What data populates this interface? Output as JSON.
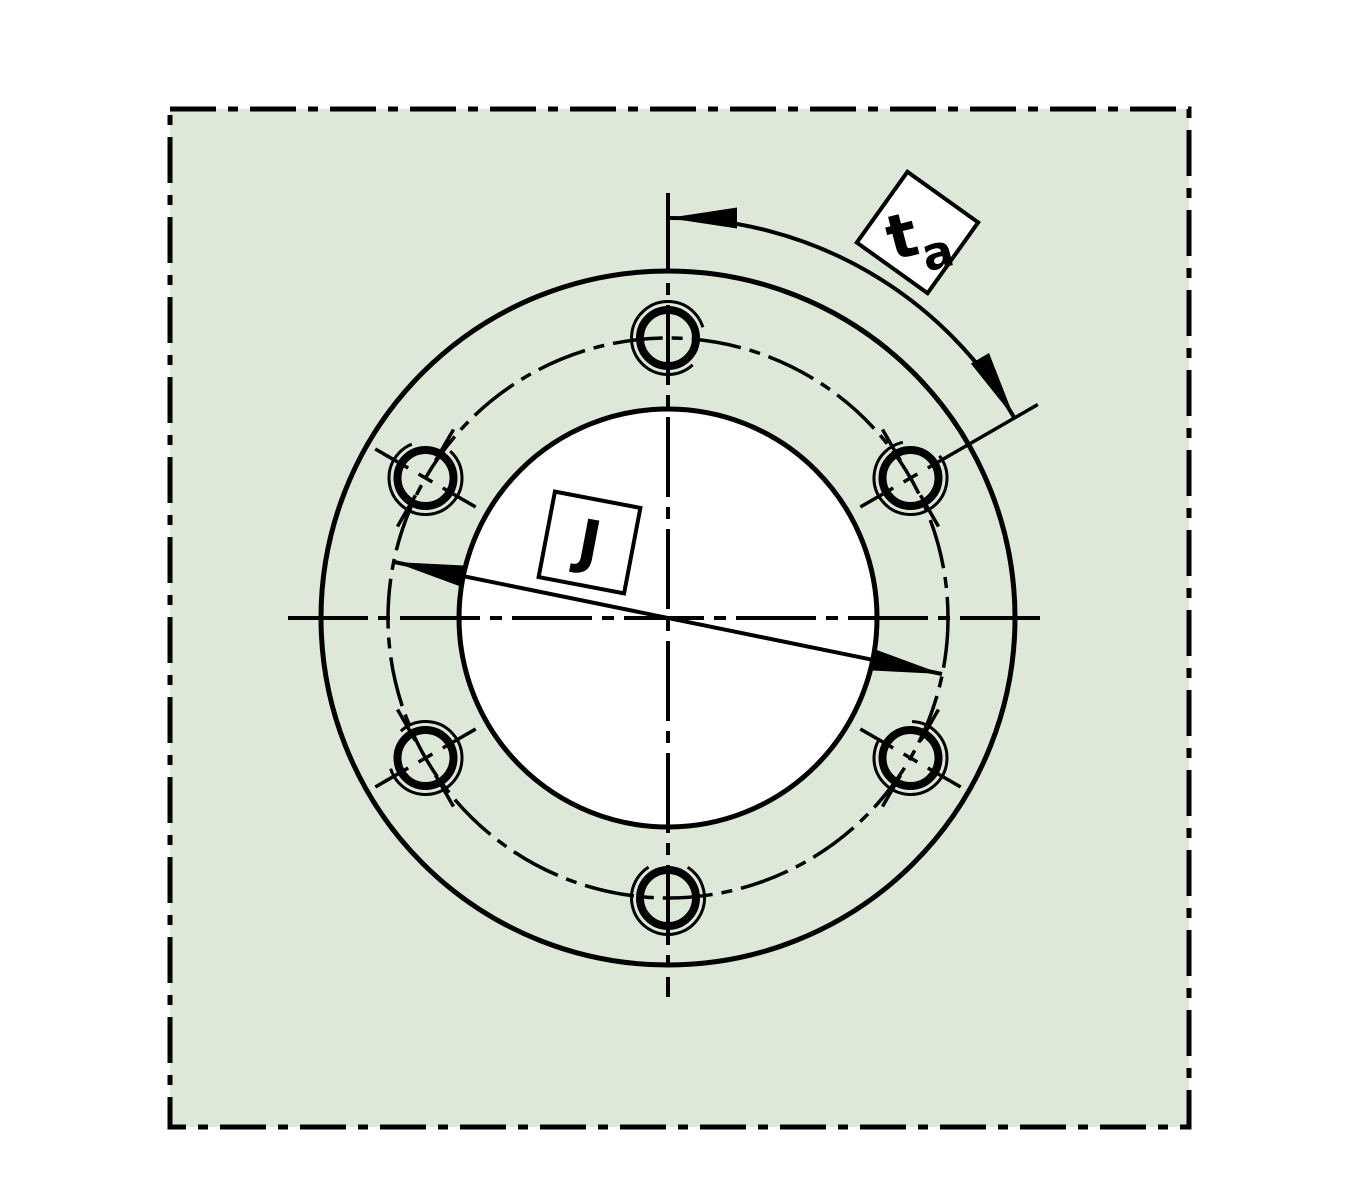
{
  "drawing": {
    "title": "flange mounting face with bolt circle",
    "bolt_hole_count": 6,
    "bolt_hole_spacing_deg": 60
  },
  "labels": {
    "bolt_circle_diameter": "J",
    "angle_main": "t",
    "angle_sub": "a"
  },
  "colors": {
    "surface_fill": "#dde8d9",
    "line": "#000000",
    "bore_fill": "#ffffff",
    "label_box_fill": "#ffffff",
    "background": "#ffffff"
  }
}
